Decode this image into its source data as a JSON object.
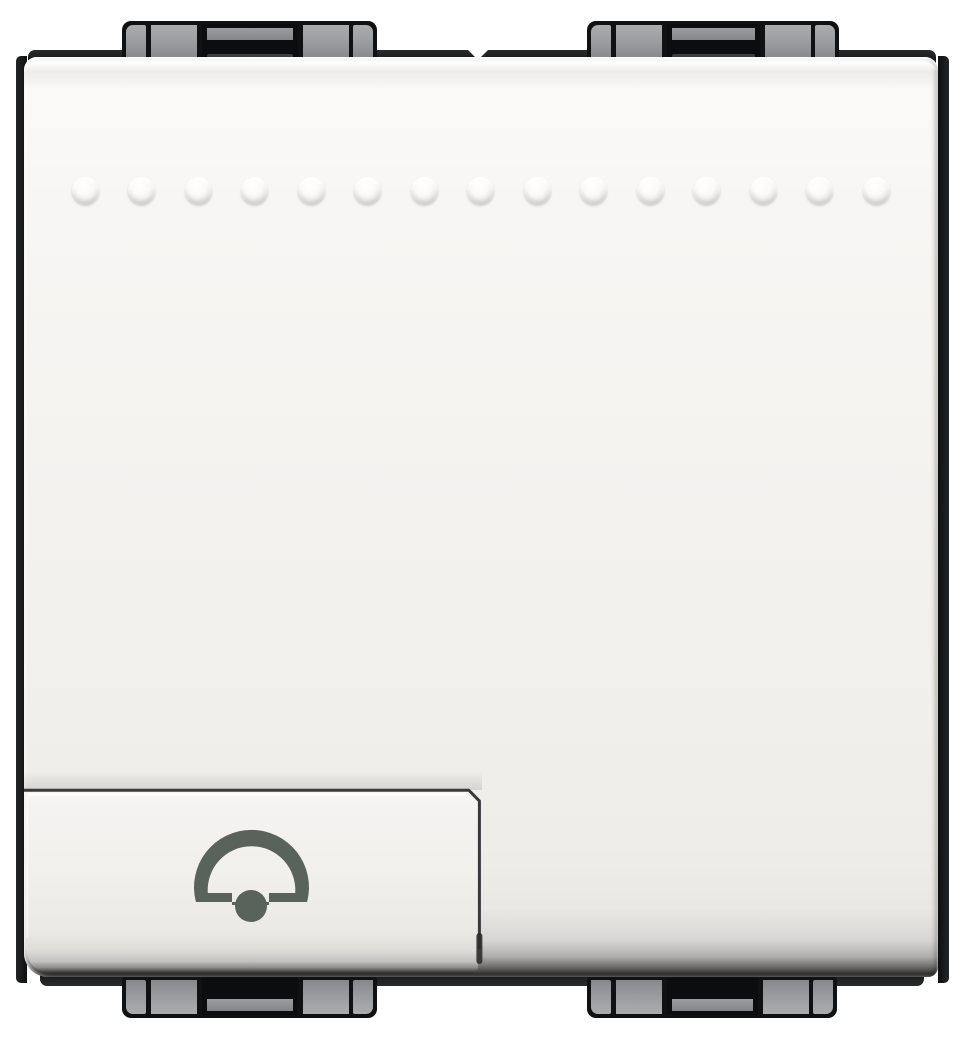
{
  "meta": {
    "description": "Product photograph of a white 2-module flush-mounted wall switch with a doorbell push button (LivingLight style)",
    "background_color": "#ffffff"
  },
  "frame": {
    "color": "#17181a",
    "clip_color": "#9b9da0",
    "clip_positions": [
      "top-left",
      "top-right",
      "bottom-left",
      "bottom-right"
    ]
  },
  "plate": {
    "color": "#f3f2ef",
    "bevel_dark_color": "#242424",
    "dots": {
      "count": 15,
      "start_x": 85,
      "spacing": 56.5,
      "center_y": 190,
      "diameter": 27
    }
  },
  "button": {
    "module": "left",
    "icon": "bell-icon",
    "icon_color": "#59635c",
    "face_color": "#f0efec"
  },
  "modules": [
    {
      "position": "left",
      "content": "bell push button"
    },
    {
      "position": "right",
      "content": "blank cover"
    }
  ]
}
